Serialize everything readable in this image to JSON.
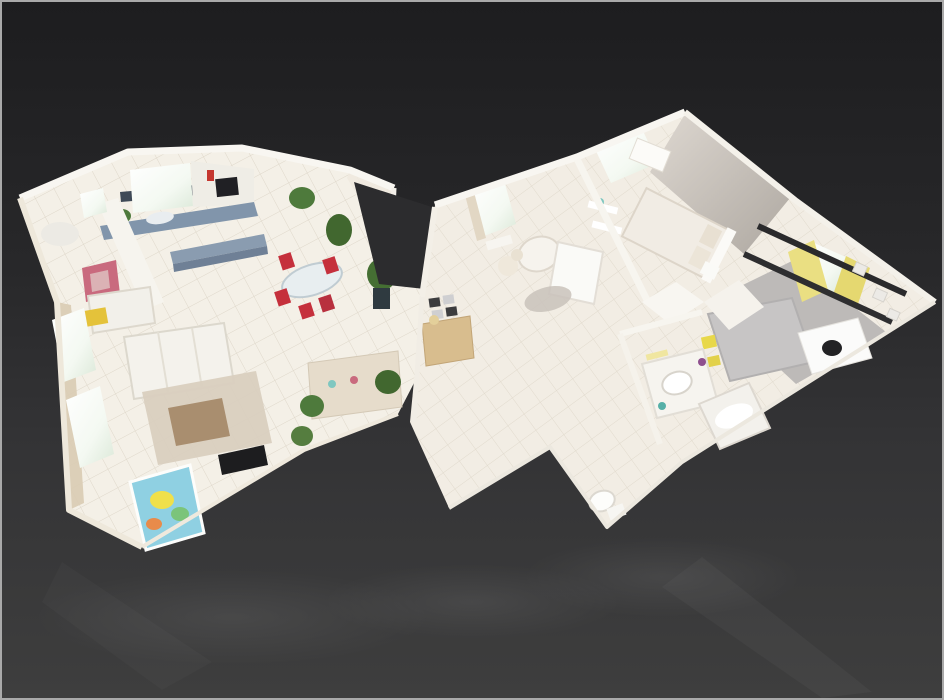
{
  "scene": {
    "type": "3d-dollhouse-floorplan",
    "style": "matterport-style cutaway apartment model viewed from above at an oblique angle",
    "floors_visible": 1
  },
  "background": {
    "gradient_top": "#1d1d1f",
    "gradient_bottom": "#3e3e3e",
    "frame_border": "#a9a9a9",
    "reflection_opacity": "0.05"
  },
  "left_wing": {
    "name": "Open living area",
    "rooms": [
      {
        "name": "Kitchen",
        "features": [
          "blue-gray countertop",
          "kitchen island",
          "white cabinets",
          "dark wall oven",
          "bright window",
          "counter plant",
          "dark backsplash wall"
        ]
      },
      {
        "name": "Dining area",
        "features": [
          "glass dining table",
          "red chairs",
          "tall potted plants",
          "glass patio door"
        ]
      },
      {
        "name": "Living room",
        "features": [
          "white three-seat sofa",
          "white loveseat",
          "yellow crate",
          "abstract pink painting",
          "beige shag rug",
          "wood coffee table",
          "flat screen TV",
          "colorful baby play mat",
          "media console",
          "curtained windows",
          "houseplants"
        ]
      },
      {
        "name": "Utility corner",
        "features": [
          "white fixtures",
          "small window"
        ]
      }
    ]
  },
  "right_wing": {
    "name": "Bedroom wing",
    "rooms": [
      {
        "name": "Entry hall",
        "features": [
          "wooden sideboard",
          "mirror tiles",
          "white tiled floor"
        ]
      },
      {
        "name": "Nursery",
        "features": [
          "white armchair",
          "changing table",
          "teddy bear",
          "round gray rug",
          "wall shelves",
          "window with curtains",
          "radiator"
        ]
      },
      {
        "name": "Master bedroom",
        "features": [
          "double bed with white linens",
          "pillows",
          "white dresser",
          "bright window",
          "warm gray feature wall"
        ]
      },
      {
        "name": "Second bedroom",
        "features": [
          "yellow curtains",
          "dark curtain rods",
          "bright window",
          "gray bed with yellow throw",
          "white desk",
          "black desk chair",
          "gray carpet",
          "framed wall pictures"
        ]
      },
      {
        "name": "Bathroom",
        "features": [
          "vanity with round sink",
          "bathtub",
          "vanity light",
          "toiletries"
        ]
      },
      {
        "name": "WC",
        "features": [
          "toilet"
        ]
      }
    ]
  },
  "palette": {
    "floor_tile": "#f4f0e7",
    "tile_line": "#c9bfae",
    "wall_white": "#f8f6f1",
    "counter_blue": "#8195ab",
    "backsplash_dark": "#3f4a57",
    "chair_red": "#c5303c",
    "plant_green": "#4e7a3c",
    "curtain_yellow": "#eadf82",
    "curtain_beige": "#d9cbb2",
    "carpet_gray": "#bdbab8",
    "rug_beige": "#d9cfbf",
    "wood": "#d8bd8e",
    "tv_black": "#1d1d1f",
    "play_mat_blue": "#8fd0e2",
    "crate_yellow": "#e4c23a",
    "painting_pink": "#c96a7e",
    "bedroom_wall_gray": "#c6c0b9"
  }
}
